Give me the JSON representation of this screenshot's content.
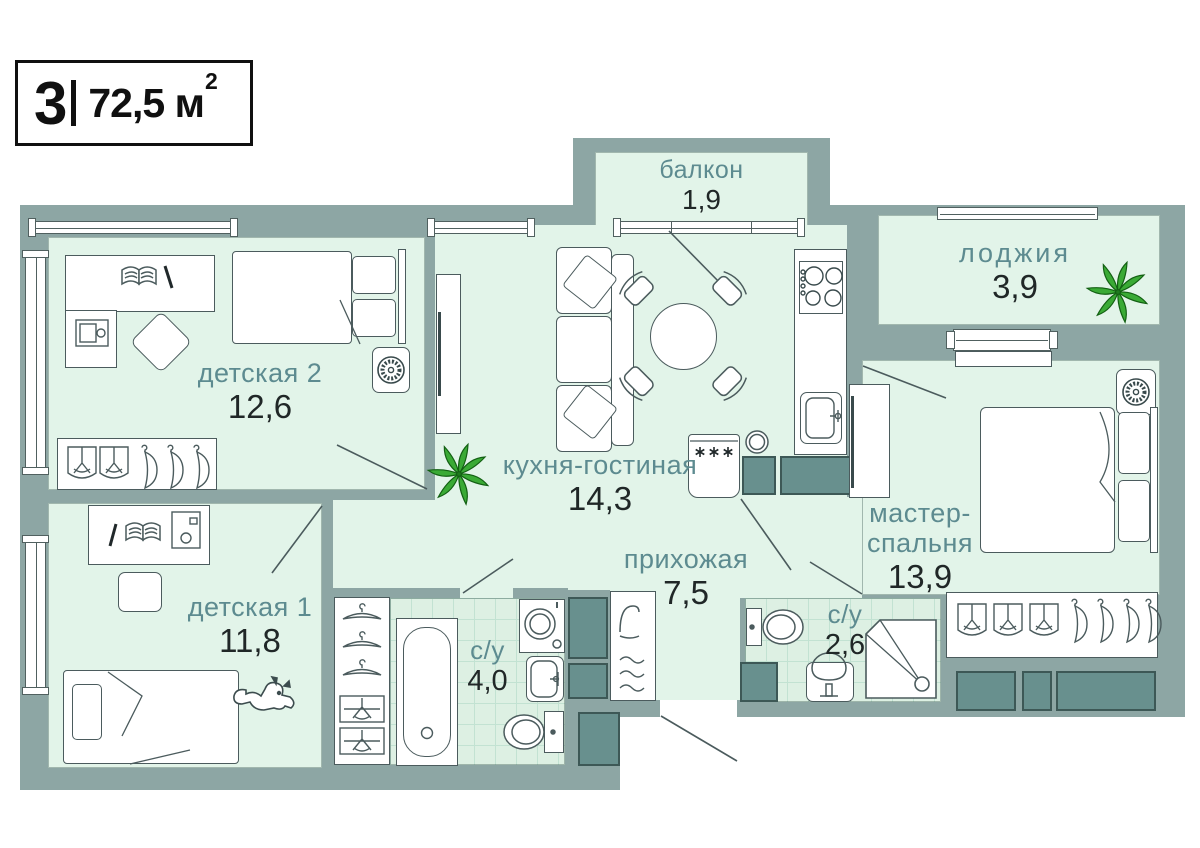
{
  "badge": {
    "rooms_count": "3",
    "area_value": "72,5",
    "area_unit": "м",
    "area_superscript": "2"
  },
  "rooms": {
    "balcony": {
      "label": "балкон",
      "area": "1,9"
    },
    "loggia": {
      "label": "лоджия",
      "area": "3,9"
    },
    "kids2": {
      "label": "детская 2",
      "area": "12,6"
    },
    "kitchen_living": {
      "label": "кухня-гостиная",
      "area": "14,3"
    },
    "master": {
      "label_line1": "мастер-",
      "label_line2": "спальня",
      "area": "13,9"
    },
    "kids1": {
      "label": "детская 1",
      "area": "11,8"
    },
    "hallway": {
      "label": "прихожая",
      "area": "7,5"
    },
    "bathroom_main": {
      "label": "с/у",
      "area": "4,0"
    },
    "bathroom_small": {
      "label": "с/у",
      "area": "2,6"
    }
  },
  "colors": {
    "wall": "#8da6a4",
    "floor": "#e2f4e9",
    "floor_tile": "#ddf0e3",
    "tile_line": "#c2e2d2",
    "dark_unit": "#68908e",
    "label_text": "#5d8b90",
    "number_text": "#202727",
    "outline": "#4b5b5d",
    "plant_green": "#3aaa35"
  },
  "icons": {
    "plant": "leaf-cluster",
    "fan": "round-fan",
    "hanger": "clothes-hanger",
    "folded_clothes": "folded-clothes",
    "book": "open-book",
    "dog": "dog",
    "mirror": "mirror",
    "shower": "shower-tray",
    "toilet": "toilet",
    "bathtub": "bathtub",
    "stove": "four-burner-stove",
    "washer": "washing-machine"
  }
}
